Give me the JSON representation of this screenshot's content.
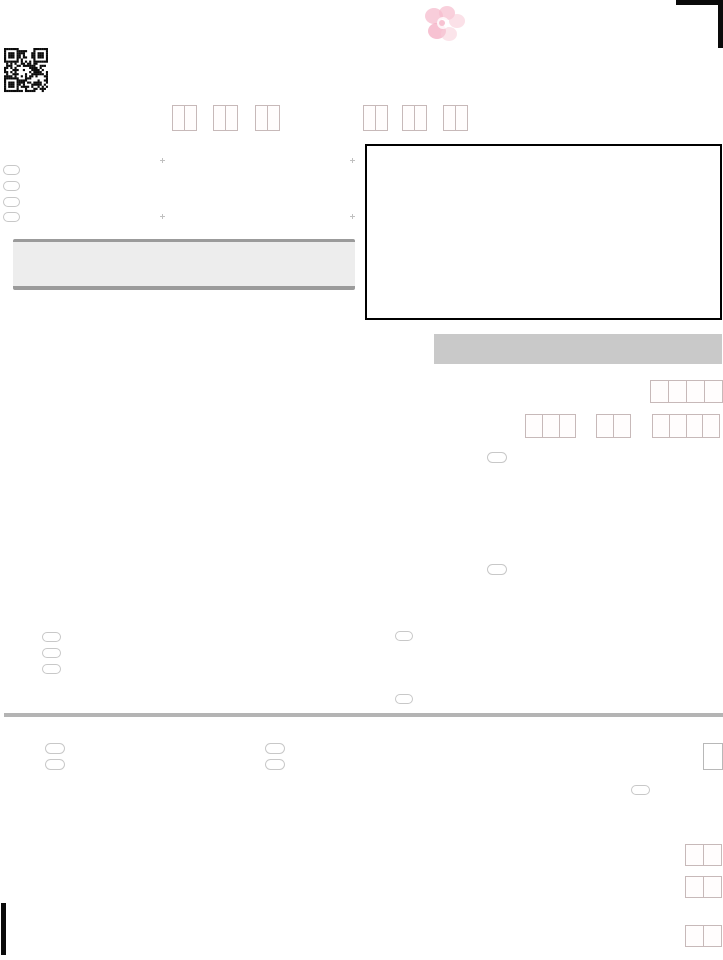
{
  "page": {
    "width": 723,
    "height": 960,
    "background": "#ffffff"
  },
  "colors": {
    "mark": "#0a0a0a",
    "digit_box_border": "#c7b9b9",
    "oval_border": "#c8c8c8",
    "band_left_fill": "#ededed",
    "band_left_border": "#9b9b9b",
    "band_right_fill": "#c9c9c9",
    "divider": "#b4b4b4",
    "frame_border": "#000000",
    "tick": "#c0c0c0",
    "flower_pink": "#f6bccd",
    "flower_pink_deep": "#f3a8bf"
  },
  "icons": {
    "qr": "qr-code",
    "flower": "cherry-blossom-watermark",
    "corner": "corner-registration-mark",
    "timing_bar": "timing-mark"
  },
  "digit_fields": {
    "top_left": [
      2,
      2,
      2
    ],
    "top_right": [
      2,
      2,
      2
    ],
    "right_row_1": [
      4
    ],
    "right_row_2": [
      3,
      2,
      4
    ],
    "bottom_right": [
      2,
      2,
      2
    ]
  },
  "option_ovals": {
    "upper_left_count": 4,
    "middle_right_count": 2,
    "middle_left_count": 3,
    "middle_center_count": 2,
    "lower_left_count": 2,
    "lower_center_count": 2,
    "lower_right_count": 1
  }
}
